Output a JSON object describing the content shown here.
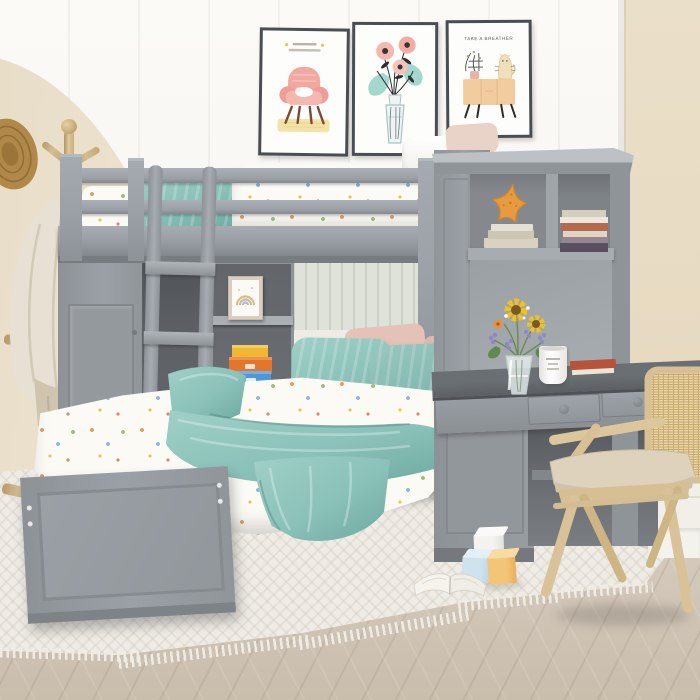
{
  "meta": {
    "description": "Product photo of a kids bedroom: gray twin loft bunk bed with built-in wardrobe, cubby shelves, desk hutch with bookshelves, and a lower twin bed with teal bedding; rattan desk chair, coat rack with towels, three wall art prints, white rug on herringbone wood floor."
  },
  "colors": {
    "wall_white": "#f7f5f0",
    "beige": "#e7dcc6",
    "beige2": "#eadfc9",
    "beadboard": "#dfe2d9",
    "beadboard_line": "#ccd0c6",
    "wainscot": "#f1efe8",
    "gray": "#9aa0a5",
    "gray_light": "#bcc1c5",
    "gray_dark": "#7e8388",
    "gray_deep": "#5f6367",
    "shelf_dark": "#6d7175",
    "desk_top": "#5c6064",
    "bed_white": "#fbfaf5",
    "teal": "#8ac1b8",
    "teal_deep": "#6ea99f",
    "blush": "#e5c2b8",
    "wood": "#d5bd92",
    "wood_dark": "#b89a6a",
    "floor": "#d5cbbd",
    "floor_dark": "#c9bdac",
    "rug": "#efece5",
    "starfish": "#e89b3e",
    "box_yellow": "#f0b832",
    "box_orange": "#e2772b",
    "box_blue": "#4e97d9",
    "sunflower": "#f2c11d",
    "purple": "#8f86c8",
    "leaf": "#5f8a4e",
    "poster_pink": "#f0a8a0",
    "poster_teal": "#a5d8cc",
    "poster_peach": "#f2cb9e",
    "frame": "#4a4d51",
    "book_red": "#b5543a",
    "towel": "#e7e0d3",
    "towel_dark": "#b9ac93"
  },
  "posters": [
    {
      "name": "armchair-print",
      "caption": ""
    },
    {
      "name": "flower-bouquet-print",
      "caption": ""
    },
    {
      "name": "cat-on-cabinet-print",
      "caption": "TAKE A BREATHER"
    }
  ],
  "inventory": [
    "gray loft bunk bed with guardrails and ladder",
    "wardrobe door under loft",
    "cubby shelf with rainbow picture and stacked boxes",
    "lower twin bed with teal pillows and throw",
    "desk hutch with starfish and books",
    "desk with two drawers, flower vase, mug and book",
    "rattan wood chair",
    "coat rack with hat and towels",
    "toy blocks and open book on rug"
  ]
}
